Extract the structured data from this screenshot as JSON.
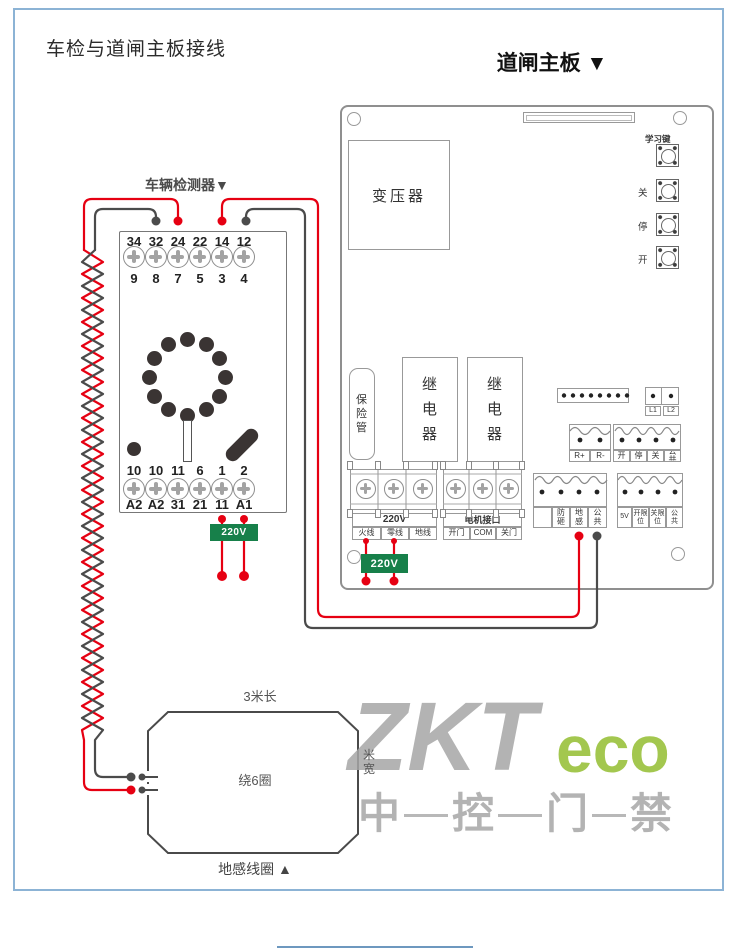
{
  "page": {
    "title": "车检与道闸主板接线"
  },
  "board": {
    "title": "道闸主板 ▼",
    "transformer_label": "变压器",
    "learn_key_label": "学习键",
    "button_labels": [
      "关",
      "停",
      "开"
    ],
    "fuse_label": "保险管",
    "relay1_label": "继电器",
    "relay2_label": "继电器",
    "l1_label": "L1",
    "l2_label": "L2",
    "r_terminals": [
      "R+",
      "R-"
    ],
    "ctrl_terminals": [
      "开",
      "停",
      "关",
      "公共"
    ],
    "power_title": "220V",
    "power_cells": [
      "火线",
      "零线",
      "地线"
    ],
    "motor_title": "电机接口",
    "motor_cells": [
      "开门",
      "COM",
      "关门"
    ],
    "sensor_cells": [
      "",
      "防砸",
      "地感",
      "公共"
    ],
    "limit_cells": [
      "5V",
      "开限位",
      "关限位",
      "公共"
    ],
    "badge_220v": "220V"
  },
  "detector": {
    "title": "车辆检测器▼",
    "top_numbers": [
      "34",
      "32",
      "24",
      "22",
      "14",
      "12"
    ],
    "top_pins": [
      "9",
      "8",
      "7",
      "5",
      "3",
      "4"
    ],
    "bottom_numbers": [
      "10",
      "10",
      "11",
      "6",
      "1",
      "2"
    ],
    "bottom_pins": [
      "A2",
      "A2",
      "31",
      "21",
      "11",
      "A1"
    ],
    "badge_220v": "220V"
  },
  "coil": {
    "length_label": "3米长",
    "turns_label": "绕6圈",
    "width_label": "米宽",
    "caption": "地感线圈 ▲"
  },
  "watermark": {
    "zkt": "ZKT",
    "eco": "eco",
    "cn": [
      "中",
      "控",
      "门",
      "禁"
    ]
  },
  "colors": {
    "wire_red": "#e60012",
    "wire_black": "#4b4b4b",
    "badge_green": "#17804a",
    "watermark_gray": "#a6a6a6",
    "watermark_green": "#9ac23c",
    "page_border": "#8cb3d5"
  }
}
